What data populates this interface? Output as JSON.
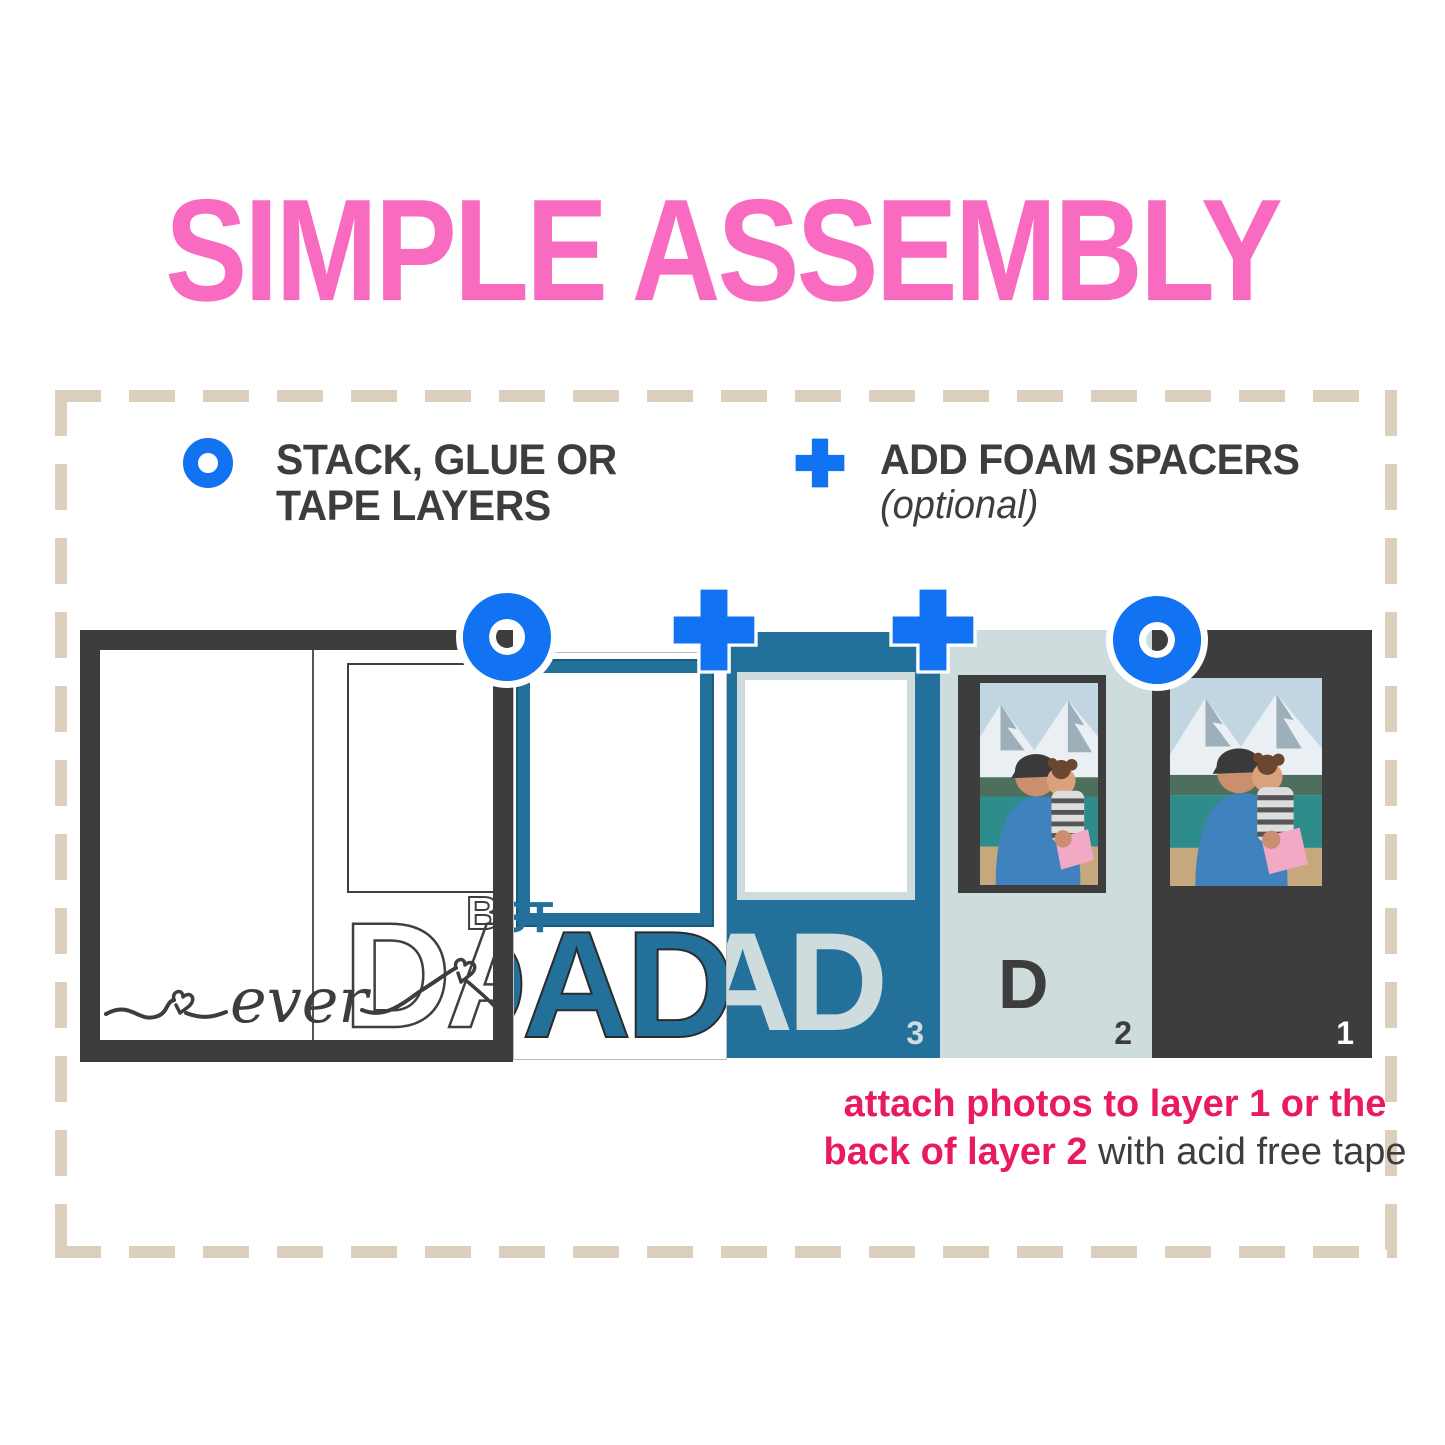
{
  "title": {
    "text": "SIMPLE ASSEMBLY",
    "color": "#f96bc1"
  },
  "legend": {
    "stack": {
      "icon": "ring-icon",
      "line1": "STACK, GLUE OR",
      "line2": "TAPE LAYERS"
    },
    "foam": {
      "icon": "plus-icon",
      "line1": "ADD FOAM SPACERS",
      "sub": "(optional)"
    }
  },
  "strip": {
    "icons": [
      "ring-icon",
      "plus-icon",
      "plus-icon",
      "ring-icon"
    ],
    "assembled": {
      "best": "BEST",
      "dad": "DAD",
      "script": "ever"
    },
    "layer4": {
      "best": "BEST",
      "dad": "DAD"
    },
    "layer3": {
      "dad": "DAD",
      "number": "3"
    },
    "layer2": {
      "letter": "D",
      "number": "2"
    },
    "layer1": {
      "number": "1"
    }
  },
  "footer": {
    "line1_bold": "attach photos to layer 1 or the",
    "line2_bold": "back of layer 2",
    "line2_regular": " with acid free tape"
  },
  "colors": {
    "title_pink": "#f96bc1",
    "accent_pink": "#ea1a5e",
    "icon_blue": "#1173f2",
    "teal": "#23709a",
    "light_blue_gray": "#cfdcdd",
    "dark_gray": "#3d3d3d",
    "dash_tan": "#dccfbe"
  }
}
